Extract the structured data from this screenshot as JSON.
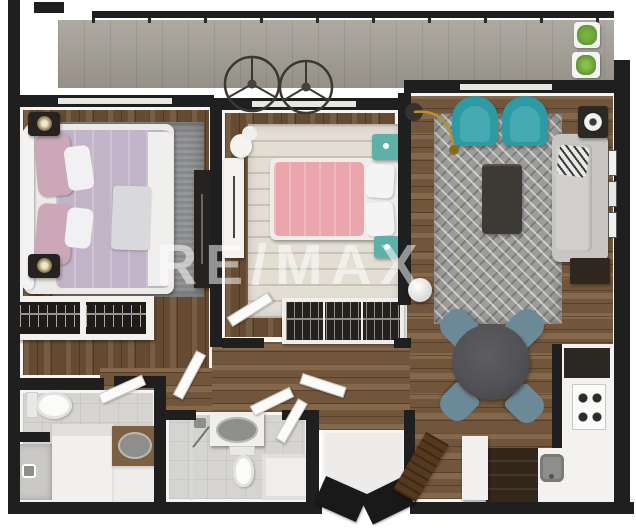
{
  "watermark": {
    "text": "RE/MAX"
  },
  "palette": {
    "wall": "#1f1f1f",
    "wood_bedroom": "#6f5338",
    "wood_living": "#7d5f41",
    "balcony_floor": "#a5a197",
    "bath_tile": "#d6d4d0",
    "entry_tile": "#edecea",
    "lining_white": "#f6f5f3",
    "rug_gray": "#8f9092",
    "rug_cream": "#e2ded4",
    "rug_chevron_base": "#9c9c9a",
    "teal_armchair": "#2d9aa4",
    "teal_nightstand": "#5fb0a8",
    "pink_duvet": "#eba6ad",
    "lilac_duvet": "#c3b3c8",
    "mauve_pillow": "#cba7b8",
    "sofa_gray": "#c8c6c2",
    "dining_chair": "#6b8996",
    "dining_table": "#515156",
    "coffee_table": "#3d3935",
    "dark_furniture": "#262220",
    "kitchen_cabinet": "#33261a",
    "bench_wood": "#54391f",
    "vanity_wood": "#7d5f41",
    "fixture_gray": "#8e8e8a",
    "plant_green": "#69a03a",
    "lamp_gold": "#b8922d",
    "door_dark": "#191919",
    "door_white": "#fbfbf9"
  },
  "plan": {
    "description": "Top-down 3D rendered floor plan of a two-bedroom apartment",
    "rooms": [
      {
        "name": "balcony",
        "furniture": [
          "railing",
          "ceiling-fan",
          "ceiling-fan",
          "potted-plant",
          "potted-plant"
        ]
      },
      {
        "name": "bedroom-1",
        "furniture": [
          "double-bed",
          "nightstand-lamp",
          "nightstand-lamp",
          "area-rug",
          "dresser",
          "open-wardrobe"
        ]
      },
      {
        "name": "bedroom-2",
        "furniture": [
          "double-bed",
          "teal-nightstand",
          "teal-nightstand",
          "area-rug",
          "dresser",
          "open-wardrobe",
          "plush-bunny"
        ]
      },
      {
        "name": "living-room",
        "furniture": [
          "sofa",
          "armchair",
          "armchair",
          "coffee-table",
          "chevron-rug",
          "arc-floor-lamp",
          "side-table-lamp",
          "wall-frames",
          "media-console",
          "globe-lamp"
        ]
      },
      {
        "name": "dining-area",
        "furniture": [
          "round-table",
          "dining-chair",
          "dining-chair",
          "dining-chair",
          "dining-chair"
        ]
      },
      {
        "name": "kitchen",
        "furniture": [
          "counter",
          "gas-stove",
          "sink",
          "dark-cabinet",
          "fridge"
        ]
      },
      {
        "name": "bathroom-1",
        "furniture": [
          "toilet",
          "shower",
          "vanity-sink"
        ]
      },
      {
        "name": "bathroom-2",
        "furniture": [
          "toilet",
          "shower",
          "vanity-sink"
        ]
      },
      {
        "name": "entry",
        "furniture": [
          "double-entry-door",
          "wood-bench",
          "side-cabinet"
        ]
      }
    ]
  }
}
